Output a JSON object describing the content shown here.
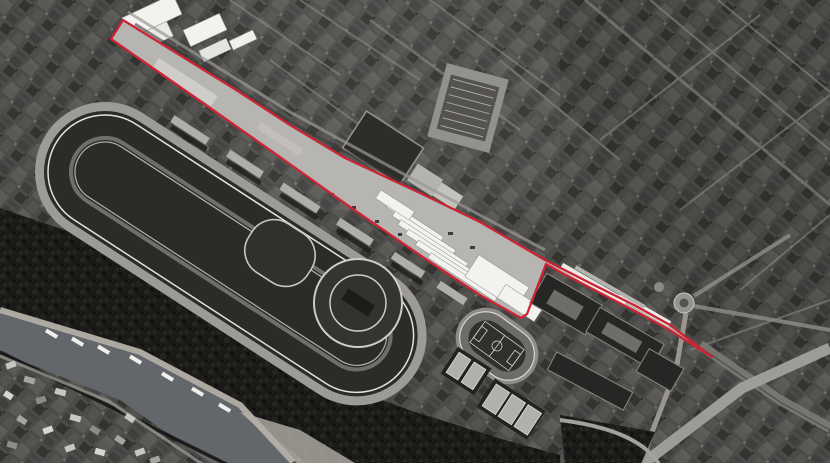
{
  "canvas": {
    "width": 830,
    "height": 466,
    "bottom_border_color": "#ffffff"
  },
  "palette": {
    "urban_base": "#4b4b49",
    "site_fill": "#b7b5b1",
    "water": "#63676b",
    "trees": "#1a1a18",
    "track": "#9d9b97",
    "infield": "#2b2b28",
    "white_roof": "#f2f2ef",
    "road": "#8f8d89",
    "dark_block": "#262624",
    "boundary_red": "#cc2433"
  },
  "site_boundary": {
    "color": "#cc2433",
    "stroke_width": 2.3,
    "points": "123,20 233,88 290,125 345,158 420,193 480,222 545,260 590,283 634,305 670,325 712,357 668,329 633,310 560,272 546,264 527,314 521,318 505,309 480,295 430,262 350,207 280,157 213,110 160,73 111,39"
  },
  "river": {
    "points": "0,313 140,355 240,408 293,466 215,466 120,400 0,352",
    "fill": "#63676b"
  },
  "racecourse": {
    "transform": "translate(105,172) rotate(33)",
    "track_color": "#9d9b97",
    "infield_color": "#2b2b28"
  },
  "circular_track": {
    "cx": 358,
    "cy": 303,
    "r_outer": 44,
    "r_inner": 28
  },
  "training_ring": {
    "cx": 280,
    "cy": 253
  },
  "athletics_stadium": {
    "transform": "translate(497,346) rotate(36)"
  },
  "roundabout": {
    "cx": 684,
    "cy": 303,
    "r": 10,
    "r_inner": 4.5
  }
}
